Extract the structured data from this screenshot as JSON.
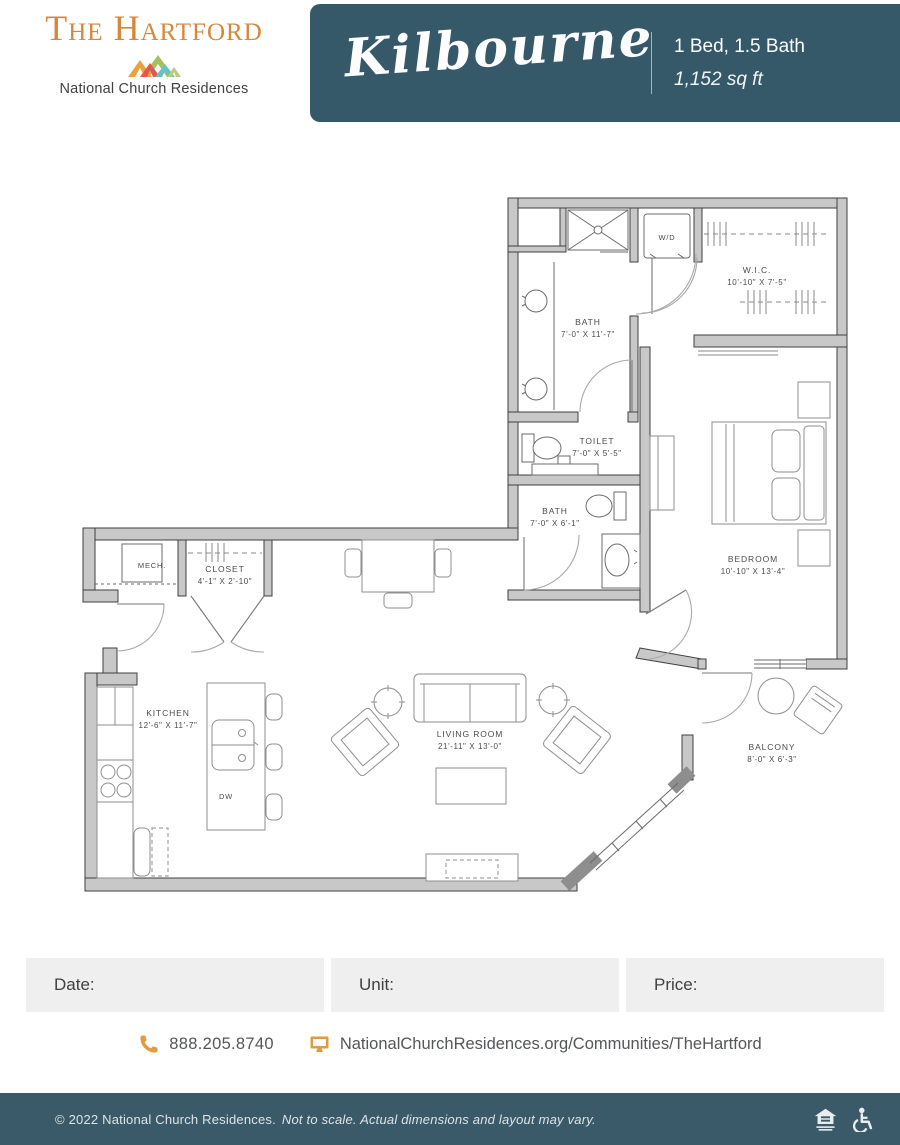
{
  "header": {
    "property_name": "The Hartford",
    "brand_name": "National Church Residences",
    "plan_name": "Kilbourne",
    "bed_bath": "1 Bed, 1.5 Bath",
    "sqft": "1,152 sq ft"
  },
  "floorplan": {
    "rooms": {
      "wic": {
        "name": "W.I.C.",
        "dims": "10'-10\" X 7'-5\""
      },
      "bath1": {
        "name": "BATH",
        "dims": "7'-0\" X 11'-7\""
      },
      "toilet": {
        "name": "TOILET",
        "dims": "7'-0\" X 5'-5\""
      },
      "bath2": {
        "name": "BATH",
        "dims": "7'-0\" X 6'-1\""
      },
      "bedroom": {
        "name": "BEDROOM",
        "dims": "10'-10\" X 13'-4\""
      },
      "mech": {
        "name": "MECH."
      },
      "closet": {
        "name": "CLOSET",
        "dims": "4'-1\" X 2'-10\""
      },
      "kitchen": {
        "name": "KITCHEN",
        "dims": "12'-6\" X 11'-7\""
      },
      "living": {
        "name": "LIVING ROOM",
        "dims": "21'-11\" X 13'-0\""
      },
      "balcony": {
        "name": "BALCONY",
        "dims": "8'-0\" X 6'-3\""
      },
      "wd": {
        "name": "W/D"
      },
      "dw": {
        "name": "DW"
      }
    }
  },
  "fields": {
    "date": {
      "label": "Date:"
    },
    "unit": {
      "label": "Unit:"
    },
    "price": {
      "label": "Price:"
    }
  },
  "contact": {
    "phone": "888.205.8740",
    "website": "NationalChurchResidences.org/Communities/TheHartford"
  },
  "footer": {
    "copyright": "© 2022 National Church Residences.",
    "disclaimer": "Not to scale. Actual dimensions and layout may vary."
  },
  "colors": {
    "banner_teal": "#36596A",
    "accent_orange": "#D5873B",
    "wall_gray": "#C8C8C8",
    "field_gray": "#EFEFEF"
  }
}
